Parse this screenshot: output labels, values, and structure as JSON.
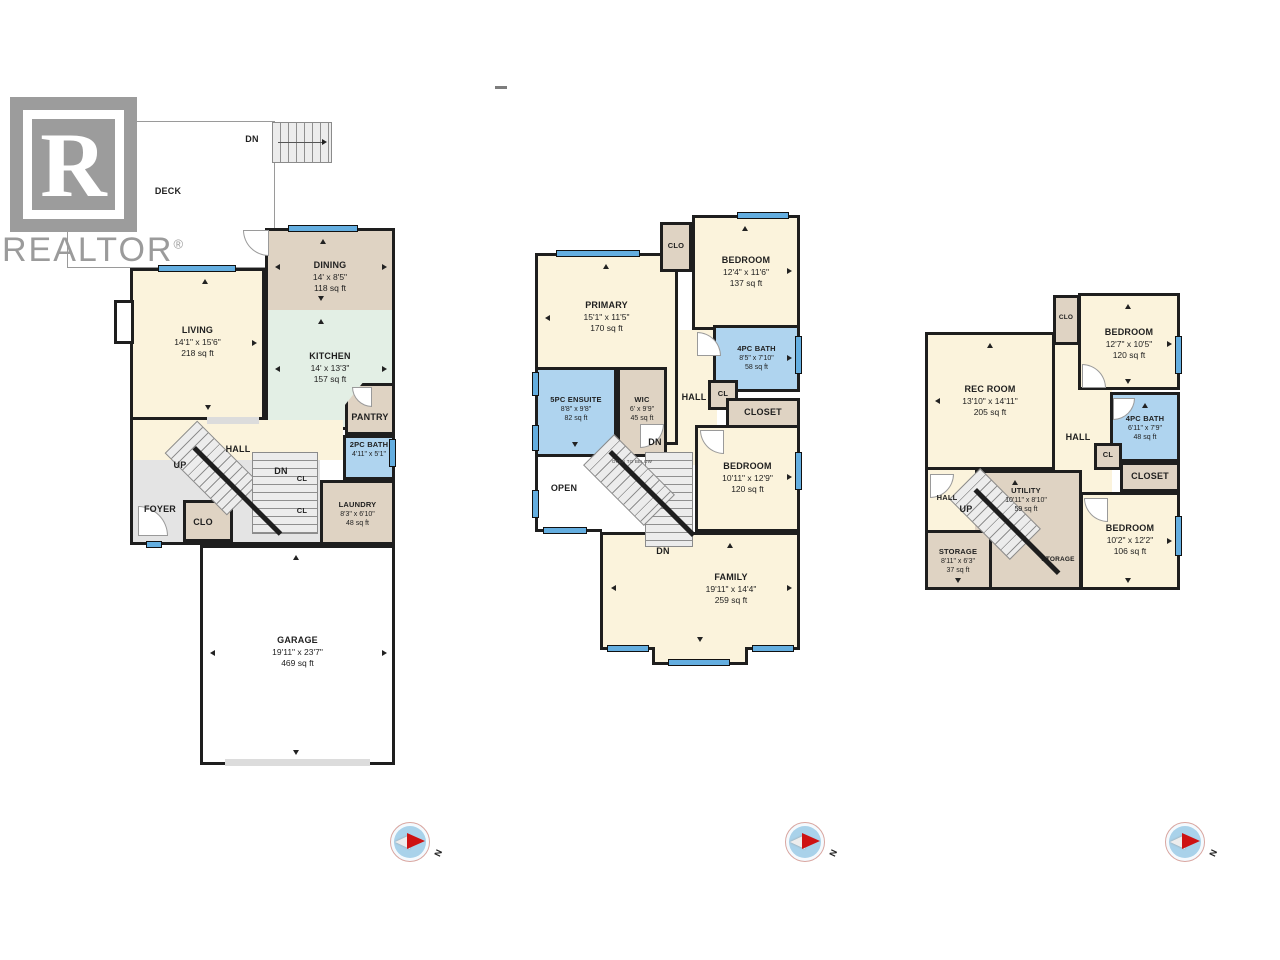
{
  "branding": {
    "logo_letter": "R",
    "wordmark": "REALTOR",
    "registered": "®"
  },
  "compass": {
    "north_label": "N"
  },
  "plans": {
    "main": {
      "deck": {
        "name": "DECK"
      },
      "deck_stairs_label": "DN",
      "living": {
        "name": "LIVING",
        "dims": "14'1\" x 15'6\"",
        "area": "218 sq ft"
      },
      "dining": {
        "name": "DINING",
        "dims": "14' x 8'5\"",
        "area": "118 sq ft"
      },
      "kitchen": {
        "name": "KITCHEN",
        "dims": "14' x 13'3\"",
        "area": "157 sq ft"
      },
      "pantry": {
        "name": "PANTRY"
      },
      "bath": {
        "name": "2PC BATH",
        "dims": "4'11\" x 5'1\""
      },
      "hall": {
        "name": "HALL"
      },
      "up_label": "UP",
      "dn_label": "DN",
      "cl1": "CL",
      "cl2": "CL",
      "foyer": {
        "name": "FOYER"
      },
      "clo": {
        "name": "CLO"
      },
      "laundry": {
        "name": "LAUNDRY",
        "dims": "8'3\" x 6'10\"",
        "area": "48 sq ft"
      },
      "garage": {
        "name": "GARAGE",
        "dims": "19'11\" x 23'7\"",
        "area": "469 sq ft"
      }
    },
    "upper": {
      "primary": {
        "name": "PRIMARY",
        "dims": "15'1\" x 11'5\"",
        "area": "170 sq ft"
      },
      "clo": {
        "name": "CLO"
      },
      "bedroom1": {
        "name": "BEDROOM",
        "dims": "12'4\" x 11'6\"",
        "area": "137 sq ft"
      },
      "bath": {
        "name": "4PC BATH",
        "dims": "8'5\" x 7'10\"",
        "area": "58 sq ft"
      },
      "hall": {
        "name": "HALL"
      },
      "cl": "CL",
      "closet": {
        "name": "CLOSET"
      },
      "ensuite": {
        "name": "5PC ENSUITE",
        "dims": "8'8\" x 9'8\"",
        "area": "82 sq ft"
      },
      "wic": {
        "name": "WIC",
        "dims": "6' x 9'9\"",
        "area": "45 sq ft"
      },
      "open": {
        "name": "OPEN"
      },
      "open_below": "OPEN TO BELOW",
      "dn1": "DN",
      "dn2": "DN",
      "bedroom2": {
        "name": "BEDROOM",
        "dims": "10'11\" x 12'9\"",
        "area": "120 sq ft"
      },
      "family": {
        "name": "FAMILY",
        "dims": "19'11\" x 14'4\"",
        "area": "259 sq ft"
      }
    },
    "basement": {
      "rec": {
        "name": "REC ROOM",
        "dims": "13'10\" x 14'11\"",
        "area": "205 sq ft"
      },
      "clo": {
        "name": "CLO"
      },
      "bedroom1": {
        "name": "BEDROOM",
        "dims": "12'7\" x 10'5\"",
        "area": "120 sq ft"
      },
      "bath": {
        "name": "4PC BATH",
        "dims": "6'11\" x 7'9\"",
        "area": "48 sq ft"
      },
      "hall": {
        "name": "HALL"
      },
      "cl": "CL",
      "closet": {
        "name": "CLOSET"
      },
      "hall2": {
        "name": "HALL"
      },
      "up_label": "UP",
      "utility": {
        "name": "UTILITY",
        "dims": "10'11\" x 8'10\"",
        "area": "59 sq ft"
      },
      "storage": {
        "name": "STORAGE",
        "dims": "8'11\" x 6'3\"",
        "area": "37 sq ft"
      },
      "storage2": "STORAGE",
      "bedroom2": {
        "name": "BEDROOM",
        "dims": "10'2\" x 12'2\"",
        "area": "106 sq ft"
      }
    }
  }
}
